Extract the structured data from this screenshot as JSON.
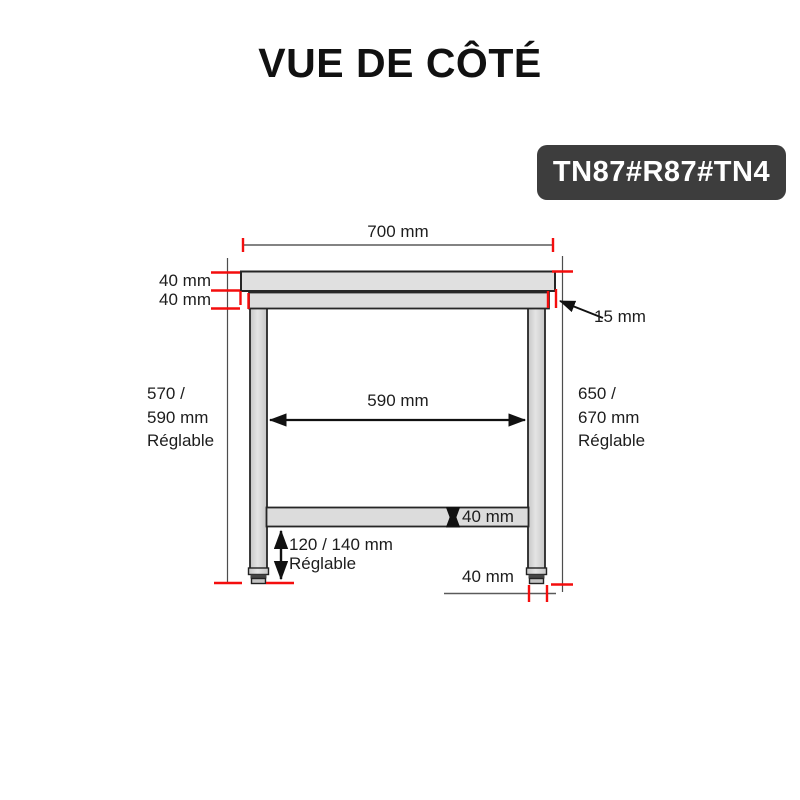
{
  "page": {
    "title": "VUE DE CÔTÉ",
    "badge": "TN87#R87#TN4"
  },
  "dims": {
    "top_width": "700 mm",
    "top_thickness": "40 mm",
    "frame_thickness": "40 mm",
    "edge_offset": "15 mm",
    "inner_width": "590 mm",
    "shelf_thickness": "40 mm",
    "foot_width": "40 mm",
    "left_height": {
      "line1": "570 /",
      "line2": "590 mm",
      "line3": "Réglable"
    },
    "right_height": {
      "line1": "650 /",
      "line2": "670 mm",
      "line3": "Réglable"
    },
    "foot_adjust": {
      "line1": "120 / 140 mm",
      "line2": "Réglable"
    }
  },
  "colors": {
    "accent_red": "#f40d0d",
    "badge_bg": "#3d3d3d",
    "metal_fill": "#dcdcdc",
    "outline": "#262626"
  }
}
